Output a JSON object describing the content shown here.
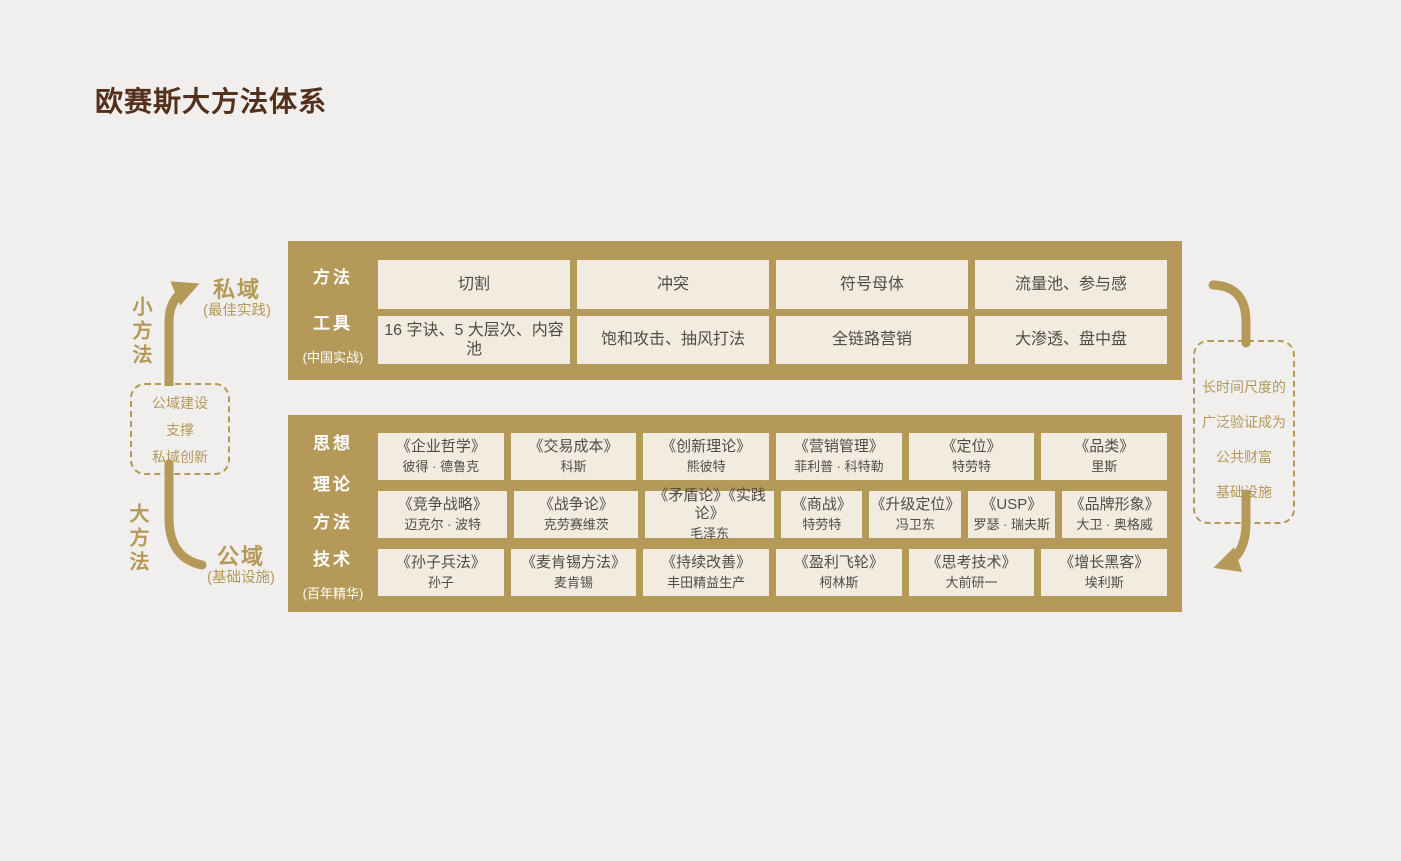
{
  "page": {
    "title": "欧赛斯大方法体系"
  },
  "colors": {
    "gold_accent": "#B49959",
    "cream_cell": "#F1EBE0",
    "background": "#F0EFED",
    "title_brown": "#53301C",
    "cell_text": "#4F4D45",
    "block_label_text": "#FFFFFF"
  },
  "left_side": {
    "small_method_label": "小方法",
    "big_method_label": "大方法",
    "private_domain": {
      "label": "私域",
      "sub": "(最佳实践)"
    },
    "public_domain": {
      "label": "公域",
      "sub": "(基础设施)"
    },
    "support_box": {
      "lines": [
        "公域建设",
        "支撑",
        "私域创新"
      ]
    }
  },
  "right_side": {
    "validation_box": {
      "lines": [
        "长时间尺度的",
        "广泛验证成为",
        "公共财富",
        "基础设施"
      ]
    }
  },
  "top_block": {
    "row_labels": [
      "方法",
      "工具"
    ],
    "footnote": "(中国实战)",
    "rows": [
      {
        "cells": [
          "切割",
          "冲突",
          "符号母体",
          "流量池、参与感"
        ]
      },
      {
        "cells": [
          "16 字诀、5 大层次、内容池",
          "饱和攻击、抽风打法",
          "全链路营销",
          "大渗透、盘中盘"
        ]
      }
    ]
  },
  "bottom_block": {
    "row_labels": [
      "思想",
      "理论",
      "方法",
      "技术"
    ],
    "footnote": "(百年精华)",
    "rows": [
      {
        "cells": [
          {
            "title": "《企业哲学》",
            "author": "彼得 · 德鲁克"
          },
          {
            "title": "《交易成本》",
            "author": "科斯"
          },
          {
            "title": "《创新理论》",
            "author": "熊彼特"
          },
          {
            "title": "《营销管理》",
            "author": "菲利普 · 科特勒"
          },
          {
            "title": "《定位》",
            "author": "特劳特"
          },
          {
            "title": "《品类》",
            "author": "里斯"
          }
        ]
      },
      {
        "cells": [
          {
            "title": "《竞争战略》",
            "author": "迈克尔 · 波特"
          },
          {
            "title": "《战争论》",
            "author": "克劳赛维茨"
          },
          {
            "title": "《矛盾论》《实践论》",
            "author": "毛泽东"
          },
          {
            "title": "《商战》",
            "author": "特劳特"
          },
          {
            "title": "《升级定位》",
            "author": "冯卫东"
          },
          {
            "title": "《USP》",
            "author": "罗瑟 · 瑞夫斯"
          },
          {
            "title": "《品牌形象》",
            "author": "大卫 · 奥格威"
          }
        ]
      },
      {
        "cells": [
          {
            "title": "《孙子兵法》",
            "author": "孙子"
          },
          {
            "title": "《麦肯锡方法》",
            "author": "麦肯锡"
          },
          {
            "title": "《持续改善》",
            "author": "丰田精益生产"
          },
          {
            "title": "《盈利飞轮》",
            "author": "柯林斯"
          },
          {
            "title": "《思考技术》",
            "author": "大前研一"
          },
          {
            "title": "《增长黑客》",
            "author": "埃利斯"
          }
        ]
      }
    ]
  }
}
